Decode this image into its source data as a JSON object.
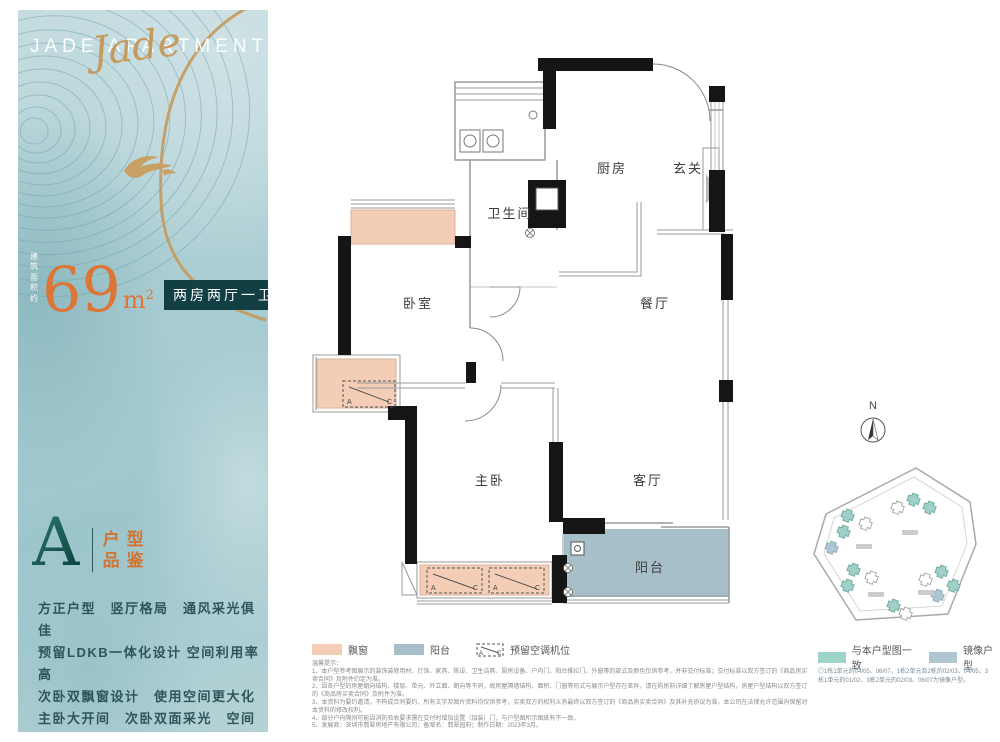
{
  "brand": {
    "logo": "JADE APARTMENTS",
    "logo_script": "Jade"
  },
  "summary": {
    "area_label_line1": "建筑",
    "area_label_line2": "面积约",
    "area_value": "69",
    "area_unit": "m",
    "area_unit_sup": "2",
    "layout_badge": "两房两厅一卫"
  },
  "grade": {
    "letter": "A",
    "label_line1": "户型",
    "label_line2": "品鉴"
  },
  "features": [
    "方正户型　竖厅格局　通风采光俱佳",
    "预留LDKB一体化设计 空间利用率高",
    "次卧双飘窗设计　使用空间更大化",
    "主卧大开间　次卧双面采光　空间敞亮"
  ],
  "floor_plan": {
    "rooms": {
      "bedroom": "卧室",
      "bathroom": "卫生间",
      "kitchen": "厨房",
      "foyer": "玄关",
      "dining": "餐厅",
      "master": "主卧",
      "living": "客厅",
      "balcony": "阳台"
    },
    "ac_a": "A",
    "ac_c": "C"
  },
  "legend": {
    "bay_window": "飘窗",
    "balcony": "阳台",
    "ac_reserved": "预留空调机位",
    "same_as_plan": "与本户型图一致",
    "mirrored": "镜像户型"
  },
  "site": {
    "north_label": "N",
    "note": "◎1栋1单元的04/05、06/07，1栋2单元及2栋的02/03、04/05，3栋1单元的01/02，3栋2单元的02/03、06/07为镜像户型。"
  },
  "notes": {
    "title": "温馨提示：",
    "items": [
      "1、本户型参考图展示的装饰装修用材、灯饰、家具、陈设、卫生洁具、厨房设备、户内门、阳台推拉门、外窗等的款式及颜色仅供参考，并非交付标准；交付标准以双方签订的《商品房买卖合同》及附件约定为准。",
      "2、因各户型的房屋朝向结构、楼层、单元、外立面、朝向等不同，故房屋隔墙结构、面积、门窗等形式与展示户型存在差异，请在购房前详细了解房屋户型结构，房屋户型结构以双方签订的《商品房买卖合同》及附件为准。",
      "3、本资料为要约邀请，不构成合同要约，所有文字及图片资料均仅供参考，买卖双方的权利义务最终以双方签订的《商品房买卖合同》及其补充协议为准，本公司在法律允许范围内保留对本资料的修改权利。",
      "4、部分户内隔间可能因消防验收要求需在交付时增加设置（加装）门，与户型图所示图纸有不一致。",
      "5、发展商：深圳市翡翠房地产有限公司；备案名：翡翠园府；制作日期：2023年3月。"
    ]
  },
  "colors": {
    "teal_dark": "#113f44",
    "orange": "#dd7537",
    "bay_pink": "#f3cdb6",
    "balcony_blue": "#a7bfc9",
    "legend_teal": "#9ed3c9",
    "legend_blue_gray": "#aec6d2",
    "gold": "#c49a5f"
  }
}
